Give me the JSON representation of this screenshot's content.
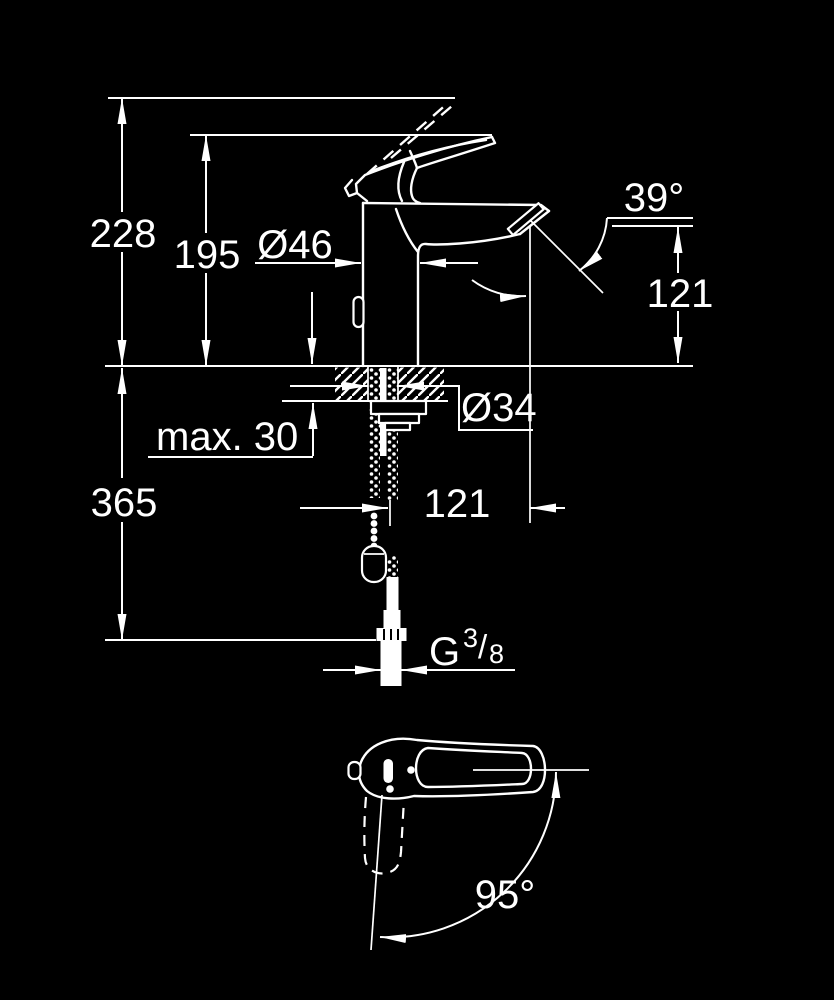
{
  "drawing": {
    "kind": "faucet technical dimension drawing",
    "background_color": "#000000",
    "line_color": "#ffffff",
    "side_view": {
      "overall_height": "228",
      "lever_height": "195",
      "body_diameter": "Ø46",
      "spout_angle": "39°",
      "outlet_height": "121",
      "counter_thickness": "max. 30",
      "install_depth": "365",
      "hole_diameter": "Ø34",
      "spout_projection": "121",
      "thread": {
        "letter": "G",
        "numerator": "3",
        "slash": "/",
        "denominator": "8"
      }
    },
    "top_view": {
      "handle_swivel_angle": "95°"
    }
  }
}
